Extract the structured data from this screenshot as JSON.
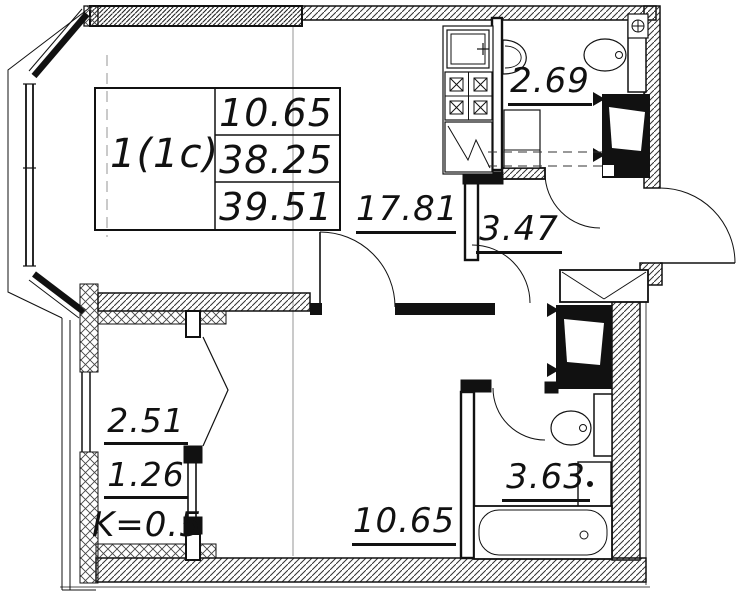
{
  "title": "Apartment floor plan",
  "plan": {
    "apartment_type": "1(1c)",
    "summary_table": {
      "living_area": "10.65",
      "apartment_area": "38.25",
      "total_area": "39.51"
    },
    "rooms": [
      {
        "id": "kitchen-living-room",
        "area": "17.81"
      },
      {
        "id": "wc",
        "area": "2.69"
      },
      {
        "id": "hallway",
        "area": "3.47"
      },
      {
        "id": "bedroom",
        "area": "10.65"
      },
      {
        "id": "bathroom",
        "area": "3.63"
      },
      {
        "id": "balcony",
        "area": "2.51"
      },
      {
        "id": "balcony-counted",
        "area": "1.26"
      },
      {
        "id": "balcony-coefficient",
        "label": "K=0.5"
      }
    ],
    "colors": {
      "line": "#111111",
      "background": "#ffffff"
    }
  }
}
